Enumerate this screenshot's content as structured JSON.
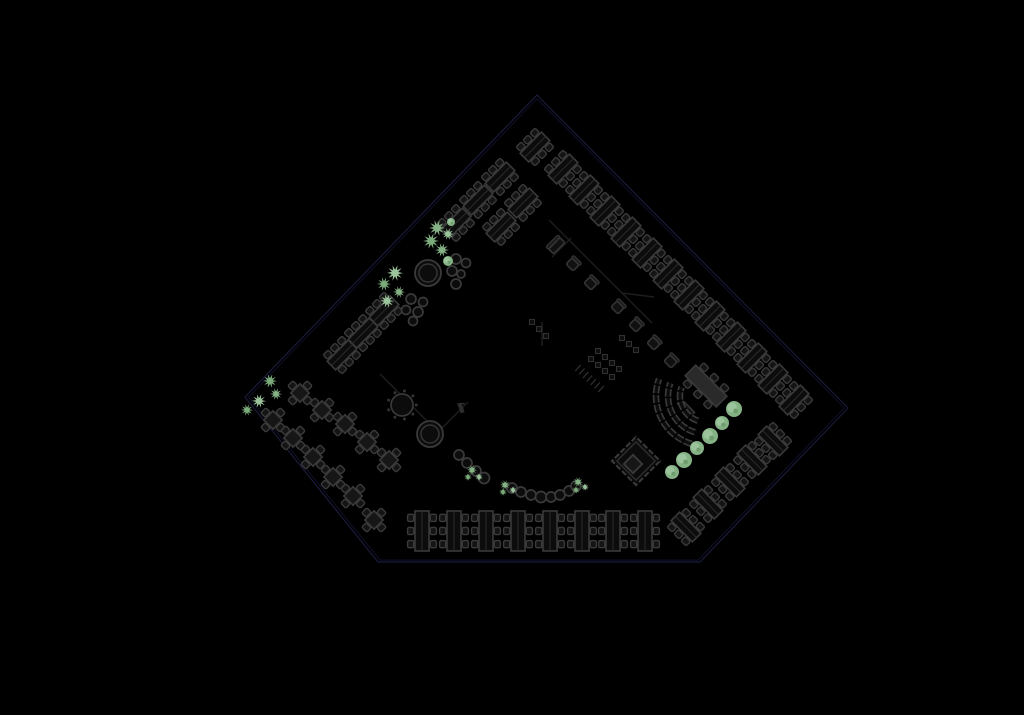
{
  "colors": {
    "background": "#000000",
    "outline": "#1a1a3a",
    "outline_inner": "#10102a",
    "furniture_stroke": "#3a3a3a",
    "furniture_fill": "#0c0c0c",
    "table_fill": "#161616",
    "chair_fill": "#141414",
    "divider": "#2a2a2a",
    "wall": "#1d1d1d",
    "stage_fill": "#2a2a2a",
    "plant_green": "#85b285",
    "plant_green_light": "#9cc49c",
    "plant_green_dark": "#6f9c6f"
  },
  "floorplan": {
    "outline": [
      [
        537,
        95
      ],
      [
        848,
        408
      ],
      [
        700,
        562
      ],
      [
        378,
        562
      ],
      [
        245,
        397
      ]
    ],
    "outline_center": [
      541.6,
      404.8
    ],
    "walls": [
      [
        549,
        220,
        652,
        323
      ],
      [
        571,
        238,
        552,
        257
      ],
      [
        622,
        293,
        654,
        297
      ],
      [
        380,
        374,
        438,
        432
      ],
      [
        438,
        432,
        468,
        402
      ],
      [
        542,
        322,
        542,
        346
      ]
    ],
    "desk_banks_ne": [
      [
        535,
        147
      ],
      [
        500,
        177
      ],
      [
        478,
        200
      ],
      [
        456,
        223
      ],
      [
        523,
        203
      ],
      [
        501,
        227
      ],
      [
        384,
        311
      ],
      [
        363,
        333
      ],
      [
        342,
        355
      ],
      [
        563,
        169
      ],
      [
        584,
        190
      ],
      [
        605,
        211
      ],
      [
        626,
        232
      ],
      [
        647,
        253
      ],
      [
        668,
        274
      ],
      [
        689,
        295
      ],
      [
        710,
        316
      ],
      [
        731,
        337
      ],
      [
        752,
        358
      ],
      [
        773,
        379
      ],
      [
        794,
        400
      ]
    ],
    "desk_banks_se": [
      [
        686,
        527
      ],
      [
        708,
        504
      ],
      [
        730,
        482
      ],
      [
        752,
        460
      ],
      [
        773,
        441
      ]
    ],
    "desk_banks_vertical_y": 531,
    "desk_banks_vertical_x": [
      422,
      454,
      486,
      518,
      550,
      582,
      613,
      645
    ],
    "meeting_tables": [
      [
        300,
        393
      ],
      [
        322,
        410
      ],
      [
        345,
        424
      ],
      [
        367,
        442
      ],
      [
        389,
        460
      ],
      [
        273,
        420
      ],
      [
        293,
        438
      ],
      [
        313,
        457
      ],
      [
        333,
        477
      ],
      [
        353,
        496
      ],
      [
        374,
        520
      ]
    ],
    "round_tables": [
      [
        428,
        273
      ],
      [
        430,
        434
      ]
    ],
    "dotted_round_tables": [
      [
        402,
        405
      ]
    ],
    "stool_clusters": [
      [
        [
          456,
          259,
          5
        ],
        [
          466,
          263,
          4.5
        ],
        [
          452,
          271,
          5
        ],
        [
          461,
          274,
          4
        ],
        [
          456,
          284,
          5
        ]
      ],
      [
        [
          411,
          299,
          5
        ],
        [
          423,
          302,
          4.5
        ],
        [
          406,
          310,
          4.5
        ],
        [
          418,
          312,
          5
        ],
        [
          413,
          321,
          4.5
        ]
      ]
    ],
    "stool_arc": [
      [
        459,
        455,
        5
      ],
      [
        467,
        463,
        5
      ],
      [
        476,
        471,
        5
      ],
      [
        484,
        478,
        5.5
      ],
      [
        512,
        488,
        5
      ],
      [
        521,
        492,
        5
      ],
      [
        531,
        495,
        5
      ],
      [
        541,
        497,
        5.5
      ],
      [
        551,
        497,
        5
      ],
      [
        560,
        495,
        5
      ],
      [
        569,
        491,
        5
      ],
      [
        576,
        486,
        5
      ]
    ],
    "lounge_chairs": [
      [
        573,
        264
      ],
      [
        591,
        283
      ],
      [
        618,
        307
      ],
      [
        636,
        325
      ],
      [
        654,
        343
      ],
      [
        671,
        361
      ]
    ],
    "sofa": [
      556,
      245
    ],
    "stage_desk": {
      "x": 706,
      "y": 386,
      "rot": 45,
      "l": 44,
      "w": 15
    },
    "small_bench": {
      "x": 686,
      "y": 408,
      "rot": 45,
      "l": 18,
      "w": 6
    },
    "arc_benches": {
      "cx": 706,
      "cy": 396,
      "radii": [
        26,
        38,
        50
      ],
      "a1": 105,
      "a2": 200
    },
    "pavilion": {
      "x": 636,
      "y": 461,
      "outer": 34,
      "mid": 27,
      "inner": 13,
      "ix": 633,
      "iy": 464
    },
    "plants_star": [
      [
        437,
        228,
        8
      ],
      [
        448,
        234,
        6
      ],
      [
        431,
        241,
        8
      ],
      [
        442,
        250,
        7
      ],
      [
        395,
        273,
        8
      ],
      [
        384,
        284,
        7
      ],
      [
        399,
        292,
        6
      ],
      [
        387,
        301,
        7
      ],
      [
        270,
        381,
        7
      ],
      [
        276,
        394,
        6
      ],
      [
        259,
        401,
        7
      ],
      [
        247,
        410,
        6
      ],
      [
        472,
        470,
        5
      ],
      [
        479,
        477,
        4
      ],
      [
        468,
        477,
        4
      ],
      [
        505,
        485,
        5
      ],
      [
        513,
        490,
        4
      ],
      [
        503,
        492,
        4
      ],
      [
        578,
        482,
        5
      ],
      [
        585,
        487,
        4
      ],
      [
        576,
        490,
        4
      ]
    ],
    "bushes": [
      [
        734,
        409,
        8
      ],
      [
        722,
        423,
        7
      ],
      [
        710,
        436,
        8
      ],
      [
        697,
        448,
        7
      ],
      [
        684,
        460,
        8
      ],
      [
        672,
        472,
        7
      ],
      [
        451,
        222,
        4
      ],
      [
        448,
        261,
        5
      ]
    ],
    "fixture_rows": [
      {
        "x": 622,
        "y": 338,
        "dx": 7,
        "dy": 6,
        "n": 3
      },
      {
        "x": 598,
        "y": 351,
        "dx": 7,
        "dy": 6,
        "n": 4
      },
      {
        "x": 591,
        "y": 359,
        "dx": 7,
        "dy": 6,
        "n": 4
      },
      {
        "x": 532,
        "y": 322,
        "dx": 7,
        "dy": 7,
        "n": 3
      }
    ],
    "stairs": {
      "x1": 578,
      "y1": 368,
      "x2": 601,
      "y2": 389,
      "steps": 7,
      "hw": 4
    },
    "flag_marker": {
      "x": 461,
      "y": 408
    }
  }
}
